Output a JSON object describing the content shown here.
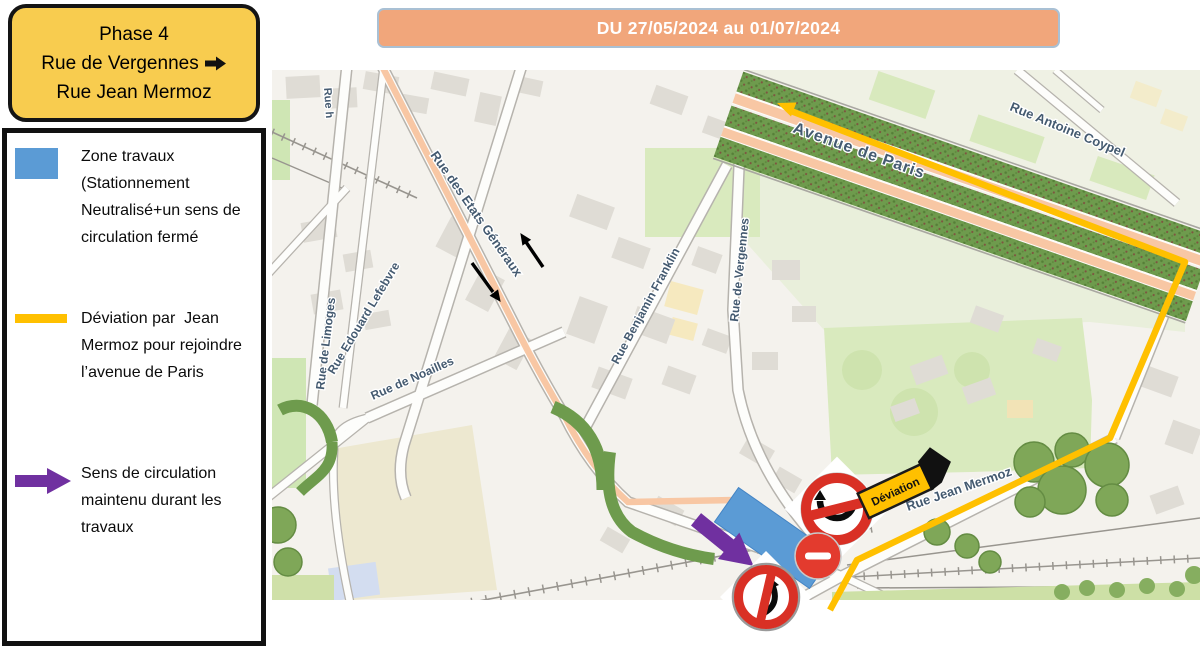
{
  "phase_box": {
    "line1": "Phase 4",
    "line2": "Rue de Vergennes",
    "line3": "Rue Jean Mermoz"
  },
  "banner": {
    "text": "DU 27/05/2024 au 01/07/2024"
  },
  "legend": {
    "items": [
      {
        "id": "work-zone",
        "label": "Zone travaux (Stationnement Neutralisé+un sens de circulation fermé",
        "color": "#5B9BD5"
      },
      {
        "id": "deviation-route",
        "label": "Déviation par  Jean Mermoz pour rejoindre l’avenue de Paris",
        "color": "#FFC000"
      },
      {
        "id": "kept-direction",
        "label": "Sens de circulation maintenu durant les travaux",
        "color": "#7030A0"
      }
    ]
  },
  "map": {
    "street_labels": {
      "partial_top": "Rue h",
      "limoges": "Rue de Limoges",
      "lefebvre": "Rue Edouard Lefebvre",
      "etats_generaux": "Rue des Etats Généraux",
      "noailles": "Rue de Noailles",
      "franklin": "Rue Benjamin Franklin",
      "vergennes": "Rue de Vergennes",
      "avenue_paris": "Avenue de Paris",
      "coypel": "Rue Antoine Coypel",
      "mermoz": "Rue Jean Mermoz"
    },
    "deviation_sign_text": "Déviation",
    "colors": {
      "route_yellow": "#FFC000",
      "work_zone_blue": "#5B9BD5",
      "kept_direction_purple": "#7030A0",
      "sign_red": "#D93025"
    }
  }
}
